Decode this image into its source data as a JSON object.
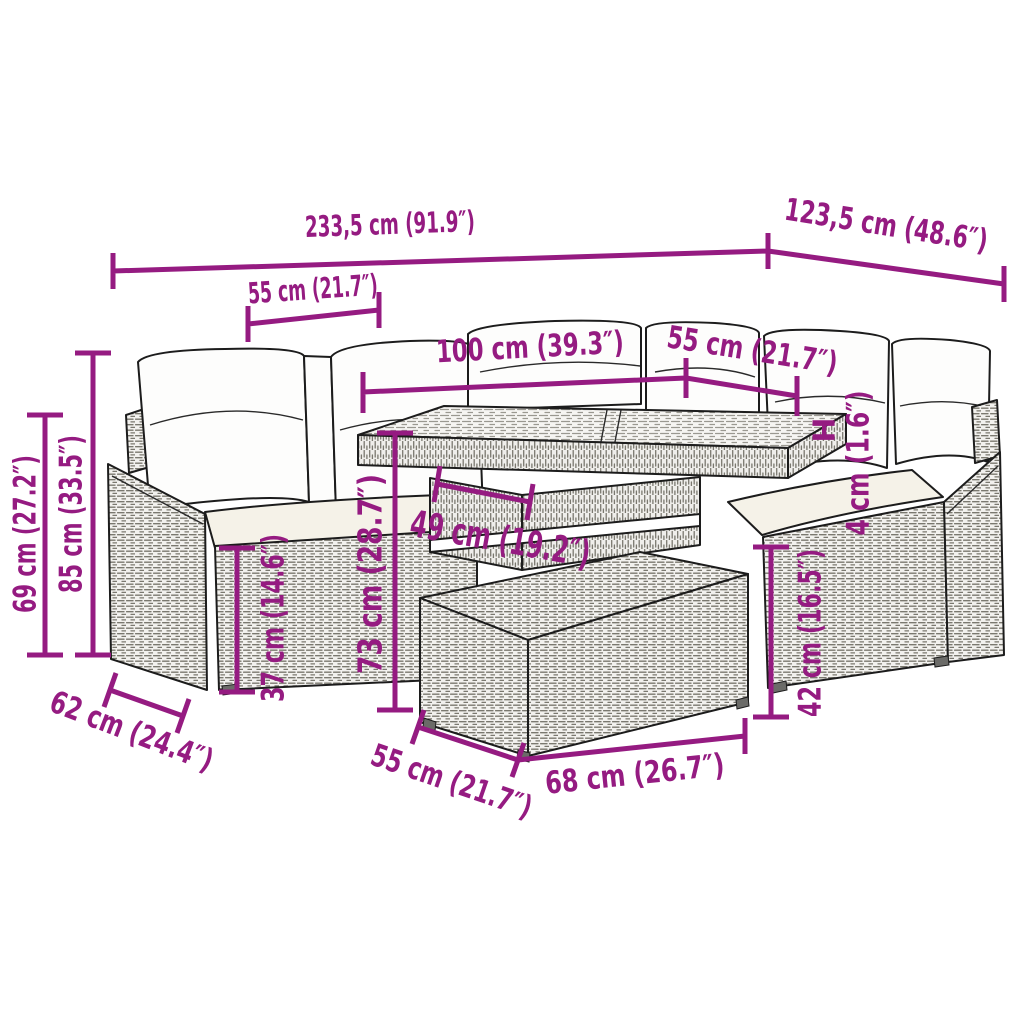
{
  "diagram": {
    "subject": "rattan-garden-sofa-set-with-table-and-footstool",
    "accent_color": "#951b81",
    "background_color": "#ffffff",
    "dimensions": {
      "overall_width": "233,5 cm (91.9″)",
      "overall_depth": "123,5 cm (48.6″)",
      "left_seat_width": "55 cm (21.7″)",
      "table_length": "100 cm (39.3″)",
      "right_seat_width": "55 cm (21.7″)",
      "back_height": "85 cm (33.5″)",
      "armrest_height": "69 cm (27.2″)",
      "seat_depth": "62 cm (24.4″)",
      "seat_height": "37 cm (14.6″)",
      "table_height": "73 cm (28.7″)",
      "table_base_width": "49 cm (19.2″)",
      "tabletop_thickness_prefix": "H",
      "tabletop_thickness": "4 cm (1.6″)",
      "stool_height": "42 cm (16.5″)",
      "stool_depth": "55 cm (21.7″)",
      "stool_width": "68 cm (26.7″)"
    }
  }
}
